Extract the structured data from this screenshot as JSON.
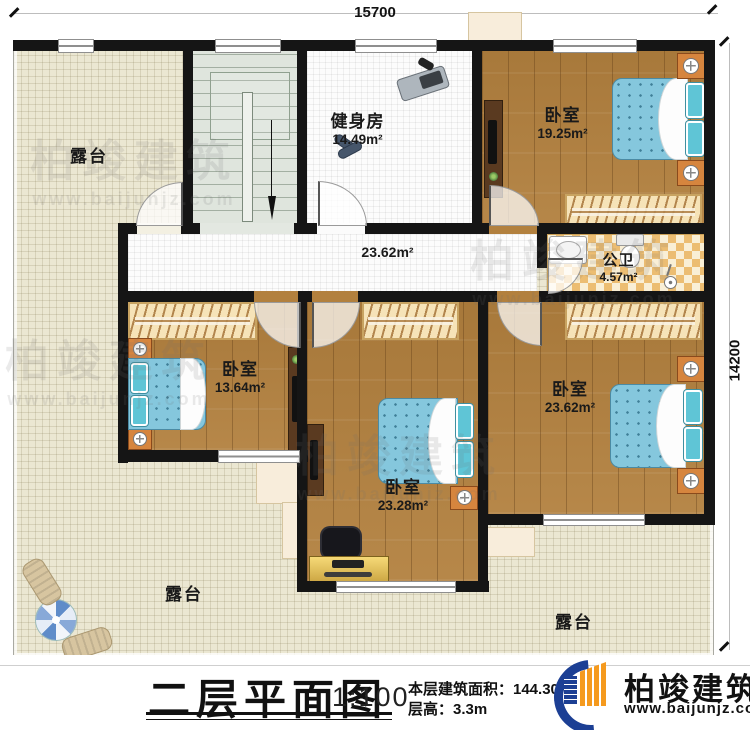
{
  "dimensions": {
    "width": "15700",
    "height": "14200"
  },
  "plan": {
    "corridor_area": "23.62m²",
    "rooms": {
      "gym": {
        "name": "健身房",
        "area": "14.49m²"
      },
      "bedroom_top_right": {
        "name": "卧室",
        "area": "19.25m²"
      },
      "bathroom": {
        "name": "公卫",
        "area": "4.57m²"
      },
      "bedroom_left": {
        "name": "卧室",
        "area": "13.64m²"
      },
      "bedroom_middle": {
        "name": "卧室",
        "area": "23.28m²"
      },
      "bedroom_bottom_right": {
        "name": "卧室",
        "area": "23.62m²"
      }
    },
    "terraces": {
      "top_left": "露台",
      "bottom_left": "露台",
      "bottom_right": "露台"
    }
  },
  "title_block": {
    "title": "二层平面图",
    "scale": "1:100",
    "floor_area": "本层建筑面积：144.30m²",
    "floor_height": "层高：3.3m"
  },
  "branding": {
    "name": "柏竣建筑",
    "website": "www.baijunjz.com"
  },
  "watermark": {
    "name": "柏竣建筑",
    "website": "www.baijunjz.com"
  },
  "colors": {
    "wall": "#151515",
    "wood": "#b2803e",
    "terrace": "#ebe7d2",
    "bed": "#85c7dd",
    "accent_orange": "#f08519",
    "accent_blue": "#1c3f94"
  }
}
